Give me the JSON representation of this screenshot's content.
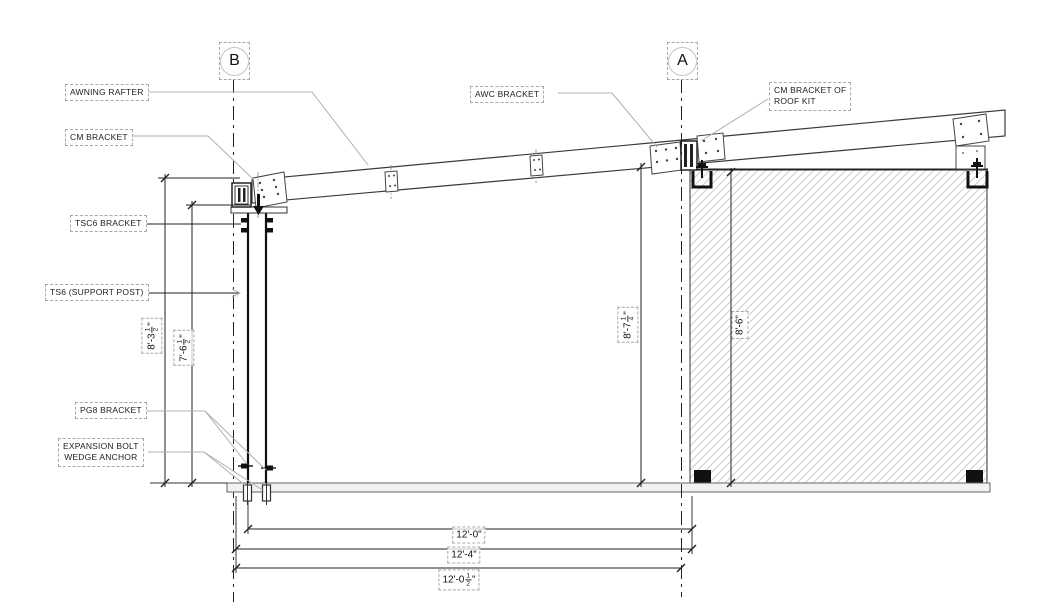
{
  "drawing": {
    "grid": {
      "b": "B",
      "a": "A"
    },
    "callouts": {
      "awning_rafter": "AWNING RAFTER",
      "cm_bracket": "CM BRACKET",
      "awc_bracket": "AWC BRACKET",
      "cm_bracket_roof_kit_line1": "CM BRACKET OF",
      "cm_bracket_roof_kit_line2": "ROOF KIT",
      "tsc6_bracket": "TSC6 BRACKET",
      "ts6_support_post": "TS6 (SUPPORT POST)",
      "pg8_bracket": "PG8 BRACKET",
      "expansion_bolt_line1": "EXPANSION BOLT",
      "expansion_bolt_line2": "WEDGE ANCHOR"
    },
    "dimensions": {
      "left_outer": {
        "prefix": "8'-3",
        "frac_num": "1",
        "frac_den": "2",
        "suffix": "\""
      },
      "left_inner": {
        "prefix": "7'-6",
        "frac_num": "1",
        "frac_den": "2",
        "suffix": "\""
      },
      "middle": {
        "prefix": "8'-7",
        "frac_num": "1",
        "frac_den": "4",
        "suffix": "\""
      },
      "wall": {
        "value": "8'-6\""
      },
      "bottom_post_to_wall": {
        "value": "12'-0\""
      },
      "bottom_mid": {
        "value": "12'-4\""
      },
      "bottom_overall": {
        "prefix": "12'-0",
        "frac_num": "1",
        "frac_den": "2",
        "suffix": "\""
      }
    },
    "appearance": {
      "line_color": "#333333",
      "leader_color": "#b0b0b0",
      "hatch_color": "#cccccc",
      "label_border_color": "#a8a8a8",
      "text_color": "#1a1a1a",
      "background": "#ffffff"
    }
  }
}
